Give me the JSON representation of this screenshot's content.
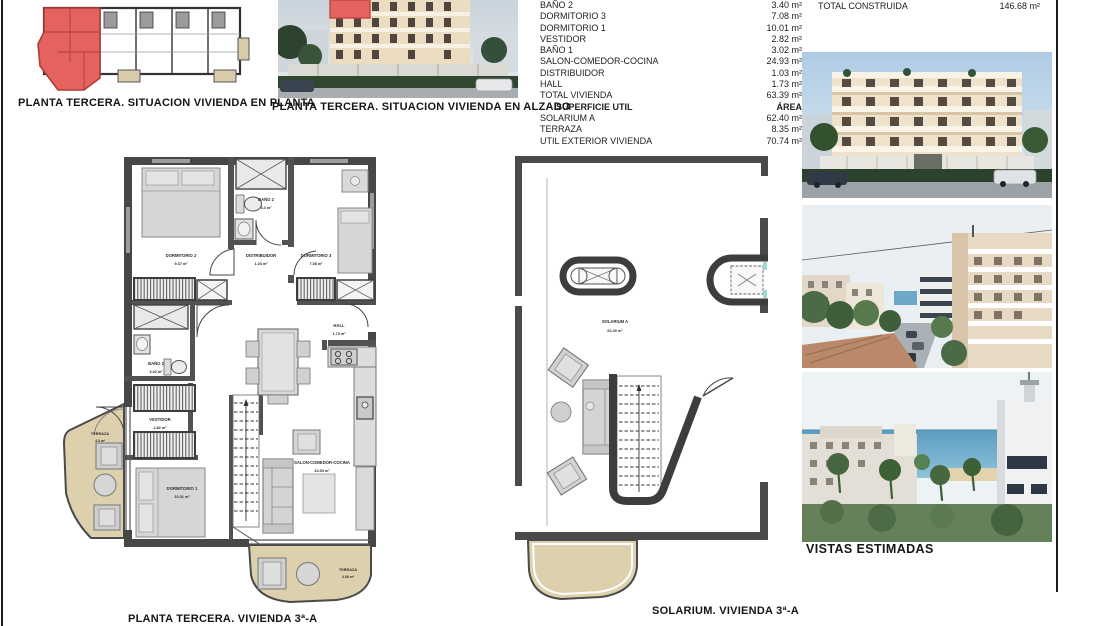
{
  "captions": {
    "plan_situacion": "PLANTA TERCERA. SITUACION VIVIENDA EN PLANTA",
    "alzado": "PLANTA TERCERA. SITUACION VIVIENDA EN ALZADO",
    "vivienda": "PLANTA TERCERA. VIVIENDA 3ª-A",
    "solarium": "SOLARIUM. VIVIENDA 3ª-A",
    "vistas": "VISTAS ESTIMADAS"
  },
  "area_table": {
    "rows": [
      {
        "label": "BAÑO 2",
        "value": "3.40 m²"
      },
      {
        "label": "DORMITORIO 3",
        "value": "7.08 m²"
      },
      {
        "label": "DORMITORIO 1",
        "value": "10.01 m²"
      },
      {
        "label": "VESTIDOR",
        "value": "2.82 m²"
      },
      {
        "label": "BAÑO 1",
        "value": "3.02 m²"
      },
      {
        "label": "SALON-COMEDOR-COCINA",
        "value": "24.93 m²"
      },
      {
        "label": "DISTRIBUIDOR",
        "value": "1.03 m²"
      },
      {
        "label": "HALL",
        "value": "1.73 m²"
      },
      {
        "label": "TOTAL VIVIENDA",
        "value": "63.39 m²"
      }
    ],
    "util_header": {
      "label": "SUPERFICIE UTIL",
      "value": "ÁREA"
    },
    "util_rows": [
      {
        "label": "SOLARIUM A",
        "value": "62.40 m²"
      },
      {
        "label": "TERRAZA",
        "value": "8.35 m²"
      },
      {
        "label": "UTIL EXTERIOR VIVIENDA",
        "value": "70.74 m²"
      }
    ],
    "total_label": "TOTAL CONSTRUIDA",
    "total_value": "146.68 m²"
  },
  "plan_rooms": {
    "dormitorio2": {
      "name": "DORMITORIO 2",
      "area": "9.37 m²"
    },
    "bano2": {
      "name": "BAÑO 2",
      "area": "3.4 m²"
    },
    "dormitorio3": {
      "name": "DORMITORIO 3",
      "area": "7.08 m²"
    },
    "distribuidor": {
      "name": "DISTRIBUIDOR",
      "area": "1.03 m²"
    },
    "hall": {
      "name": "HALL",
      "area": "1.73 m²"
    },
    "bano1": {
      "name": "BAÑO 1",
      "area": "3.02 m²"
    },
    "vestidor": {
      "name": "VESTIDOR",
      "area": "2.82 m²"
    },
    "terraza_izquierda": {
      "name": "TERRAZA",
      "area": "4.3 m²"
    },
    "dormitorio1": {
      "name": "DORMITORIO 1",
      "area": "10.01 m²"
    },
    "salon": {
      "name": "SALON-COMEDOR-COCINA",
      "area": "24.93 m²"
    },
    "terraza_inferior": {
      "name": "TERRAZA",
      "area": "4.06 m²"
    }
  },
  "solarium": {
    "name": "SOLARIUM A",
    "area": "62.40 m²"
  },
  "colors": {
    "highlight_red": "#e4635f",
    "terrace_beige": "#ddd0ad",
    "wall_dark": "#474747"
  }
}
